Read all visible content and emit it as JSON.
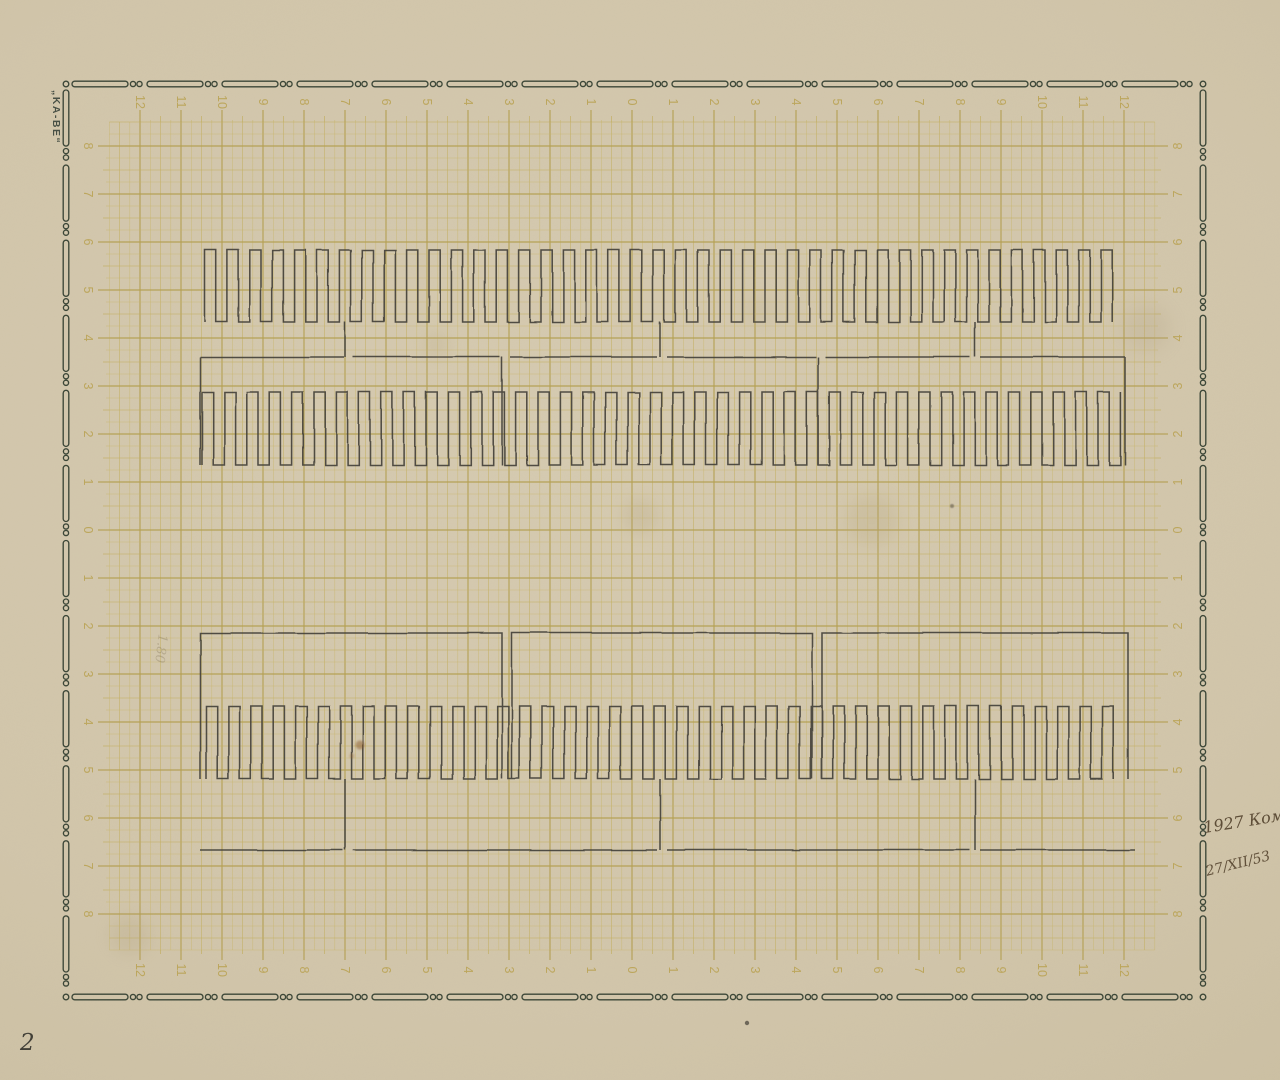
{
  "sheet": {
    "brand": "„KA-BE“",
    "page_number": "2",
    "annotations": {
      "year_note": "1927 Комб",
      "date_note": "27/XII/53",
      "pencil_note": "1.80"
    }
  },
  "colors": {
    "paper": "#d2c6ab",
    "grid_minor": "#c9b668",
    "grid_half": "#c3af5f",
    "grid_major": "#b5a052",
    "grid_number": "#bda75c",
    "border_chain": "#2f3c2e",
    "ink": "#45423a",
    "hand_ink": "#4e3d28"
  },
  "grid": {
    "x_center": 632,
    "y_center": 530,
    "x_unit": 41,
    "y_unit": 48,
    "minor_per_major": 4,
    "h_labels": [
      12,
      11,
      10,
      9,
      8,
      7,
      6,
      5,
      4,
      3,
      2,
      1,
      0,
      1,
      2,
      3,
      4,
      5,
      6,
      7,
      8,
      9,
      10,
      11,
      12
    ],
    "v_labels": [
      8,
      7,
      6,
      5,
      4,
      3,
      2,
      1,
      0,
      1,
      2,
      3,
      4,
      5,
      6,
      7,
      8
    ],
    "mesh_k_x": 51,
    "mesh_k_y_top": 34,
    "mesh_k_y_bot": 35,
    "label_k_x": 48,
    "label_k_y": 32
  },
  "border_rect": {
    "x": 66,
    "y": 84,
    "w": 1137,
    "h": 913
  },
  "pattern": {
    "tooth_pitch": 11.2,
    "upper": {
      "wave1": {
        "x0": 205,
        "x1": 1122,
        "y_top": 250,
        "y_bot": 322
      },
      "bus_y": 357,
      "bus_segments": [
        [
          200,
          344
        ],
        [
          353,
          500
        ],
        [
          510,
          657
        ],
        [
          667,
          816
        ],
        [
          825,
          970
        ],
        [
          980,
          1125
        ]
      ],
      "drops": [
        345,
        660,
        975
      ],
      "drop_y0": 322,
      "drop_y1": 357,
      "frames": [
        200,
        502,
        818,
        1125
      ],
      "frame_y0": 357,
      "frame_y1": 465,
      "wave2": {
        "x0": 202,
        "x1": 1123,
        "y_top": 392,
        "y_bot": 465
      }
    },
    "lower": {
      "boxes": [
        [
          200,
          502
        ],
        [
          512,
          812
        ],
        [
          822,
          1128
        ]
      ],
      "box_y": 633,
      "box_bottom": 779,
      "wave": {
        "x0": 206,
        "x1": 1122,
        "y_top": 706,
        "y_bot": 779
      },
      "drops": [
        345,
        660,
        975
      ],
      "drop_y0": 779,
      "drop_y1": 850,
      "bus_y": 850,
      "bus_segments": [
        [
          200,
          343
        ],
        [
          353,
          657
        ],
        [
          667,
          970
        ],
        [
          980,
          1135
        ]
      ]
    }
  },
  "stains": [
    {
      "x": 360,
      "y": 745,
      "r": 4.5,
      "color": "#8a5a28",
      "opacity": 0.5,
      "blur": 1
    },
    {
      "x": 352,
      "y": 756,
      "r": 2.5,
      "color": "#9a6a30",
      "opacity": 0.35,
      "blur": 1
    },
    {
      "x": 872,
      "y": 520,
      "r": 26,
      "color": "#b4a378",
      "opacity": 0.22,
      "blur": 8
    },
    {
      "x": 640,
      "y": 516,
      "r": 18,
      "color": "#b09e74",
      "opacity": 0.2,
      "blur": 7
    },
    {
      "x": 1146,
      "y": 328,
      "r": 24,
      "color": "#a89778",
      "opacity": 0.18,
      "blur": 9
    },
    {
      "x": 952,
      "y": 506,
      "r": 2,
      "color": "#4a443a",
      "opacity": 0.5,
      "blur": 0.4
    },
    {
      "x": 747,
      "y": 1023,
      "r": 2.2,
      "color": "#3a362e",
      "opacity": 0.65,
      "blur": 0.3
    },
    {
      "x": 130,
      "y": 935,
      "r": 20,
      "color": "#a99872",
      "opacity": 0.18,
      "blur": 8
    },
    {
      "x": 437,
      "y": 345,
      "r": 14,
      "color": "#b2a179",
      "opacity": 0.16,
      "blur": 6
    },
    {
      "x": 760,
      "y": 310,
      "r": 16,
      "color": "#b2a179",
      "opacity": 0.14,
      "blur": 7
    }
  ]
}
